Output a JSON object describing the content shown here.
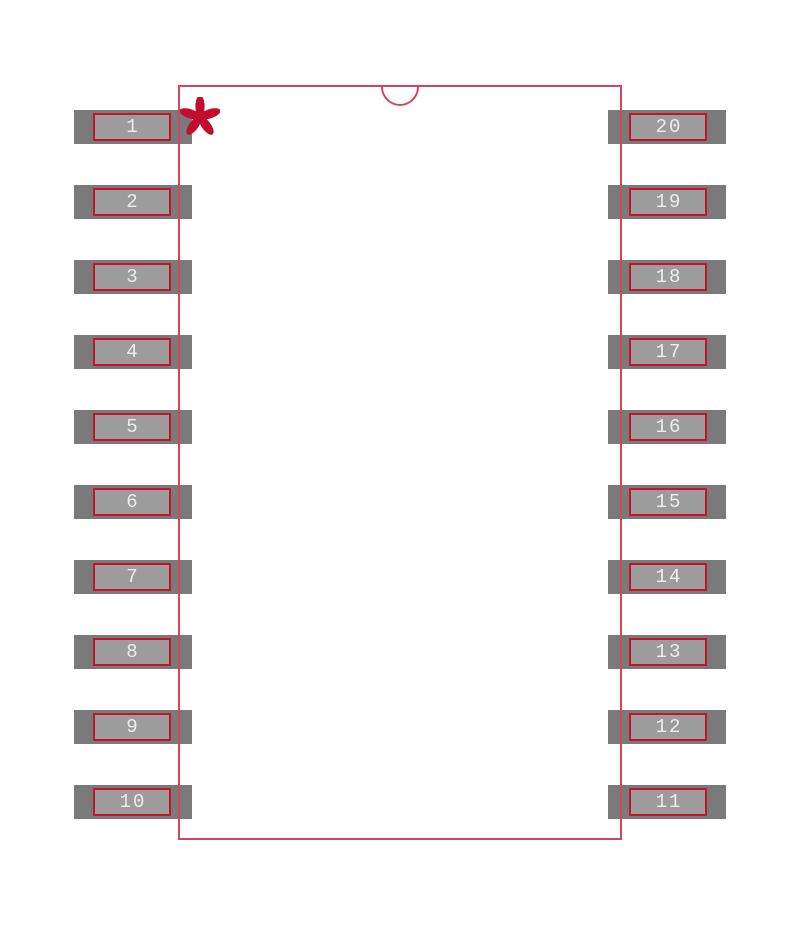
{
  "canvas": {
    "width": 800,
    "height": 929,
    "background": "#ffffff"
  },
  "colors": {
    "body_outline": "#d4455f",
    "pad_base": "#7a7a7a",
    "pad_inner": "#9c9c9c",
    "pad_outline": "#c6122f",
    "pin_number_text": "#ededed",
    "pin1_marker": "#c20e2e"
  },
  "body": {
    "x": 178,
    "y": 85,
    "width": 444,
    "height": 755,
    "notch_width": 38,
    "notch_depth": 19
  },
  "pads": {
    "pitch": 75,
    "first_top_y": 110,
    "pad_width": 118,
    "pad_height": 34,
    "inner_width": 78,
    "inner_height": 28,
    "left_x": 74,
    "right_x": 608
  },
  "pins": {
    "left": [
      "1",
      "2",
      "3",
      "4",
      "5",
      "6",
      "7",
      "8",
      "9",
      "10"
    ],
    "right": [
      "20",
      "19",
      "18",
      "17",
      "16",
      "15",
      "14",
      "13",
      "12",
      "11"
    ]
  },
  "icons": {
    "pin1_marker": "asterisk-icon",
    "orientation_notch": "half-circle-notch-icon"
  }
}
